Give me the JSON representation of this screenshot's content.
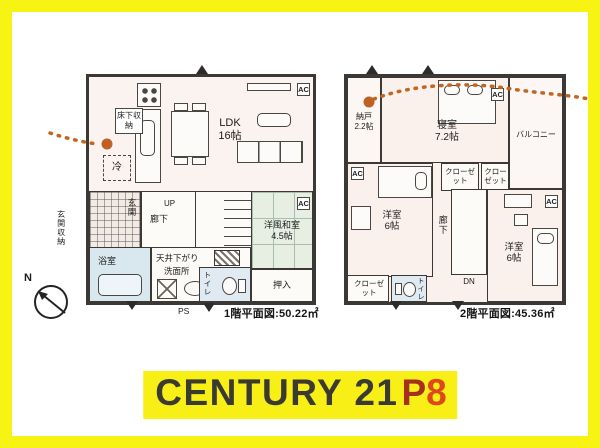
{
  "frame": {
    "border_color": "#f7f312",
    "background": "#ffffff"
  },
  "compass": {
    "north_label": "N"
  },
  "floor1": {
    "caption": "1階平面図:50.22㎡",
    "ldk_name": "LDK",
    "ldk_size": "16帖",
    "floor_storage": "床下収納",
    "fridge": "冷",
    "entrance": "玄関",
    "entrance_storage": "玄関収納",
    "hallway": "廊下",
    "stairs_up": "UP",
    "ceiling_drop": "天井下がり",
    "washroom": "洗面所",
    "bathroom": "浴室",
    "toilet": "トイレ",
    "pipe_space": "PS",
    "futon_closet": "押入",
    "tatami_room": "洋風和室",
    "tatami_size": "4.5帖",
    "ac_unit": "AC"
  },
  "floor2": {
    "caption": "2階平面図:45.36㎡",
    "storeroom": "納戸",
    "storeroom_size": "2.2帖",
    "bedroom": "寝室",
    "bedroom_size": "7.2帖",
    "balcony": "バルコニー",
    "closet": "クローゼット",
    "western_room": "洋室",
    "western_room_size": "6帖",
    "hallway": "廊下",
    "stairs_down": "DN",
    "toilet": "トイレ",
    "ac_unit": "AC"
  },
  "banner": {
    "brand": "CENTURY 21",
    "suffix_p": "P",
    "suffix_8": "8",
    "brand_color": "#3a3a33",
    "suffix_p_color": "#a5301d",
    "suffix_8_color": "#df471c",
    "highlight_color": "#f8ef16"
  }
}
